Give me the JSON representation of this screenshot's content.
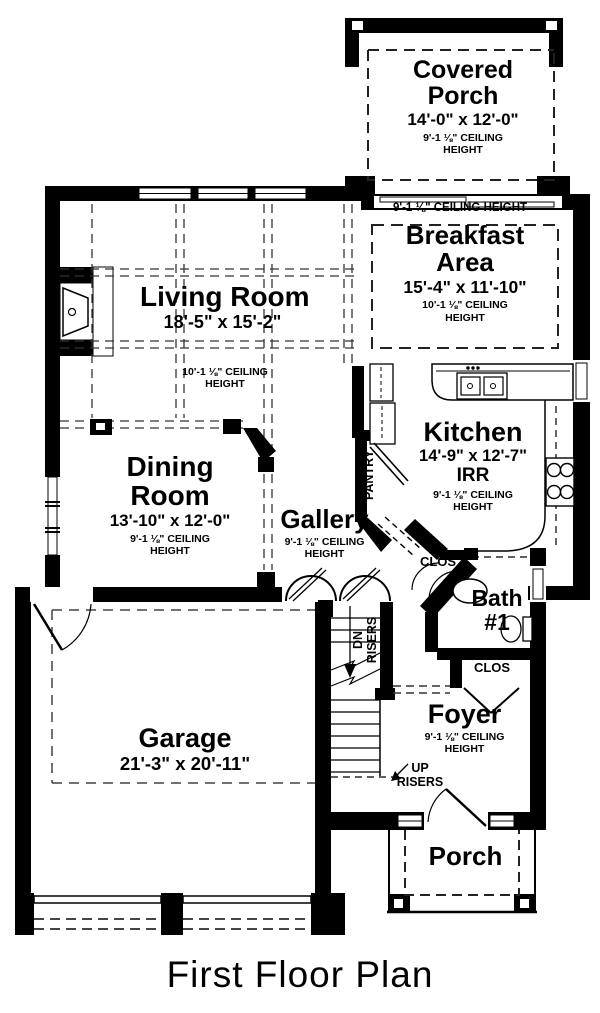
{
  "title": "First Floor Plan",
  "rooms": {
    "covered_porch": {
      "name": "Covered Porch",
      "dims": "14'-0\" x 12'-0\"",
      "ceiling": "9'-1 ⅛\" CEILING HEIGHT"
    },
    "entry_strip": {
      "ceiling": "9'-1 ⅛\" CEILING HEIGHT"
    },
    "breakfast": {
      "name": "Breakfast Area",
      "dims": "15'-4\" x 11'-10\"",
      "ceiling": "10'-1 ⅛\" CEILING HEIGHT"
    },
    "living": {
      "name": "Living Room",
      "dims": "18'-5\" x 15'-2\"",
      "ceiling": "10'-1 ⅛\" CEILING HEIGHT"
    },
    "kitchen": {
      "name": "Kitchen",
      "dims": "14'-9\" x 12'-7\"",
      "note": "IRR",
      "ceiling": "9'-1 ⅛\" CEILING HEIGHT"
    },
    "dining": {
      "name": "Dining Room",
      "dims": "13'-10\" x 12'-0\"",
      "ceiling": "9'-1 ⅛\" CEILING HEIGHT"
    },
    "gallery": {
      "name": "Gallery",
      "ceiling": "9'-1 ⅛\" CEILING HEIGHT"
    },
    "pantry": {
      "name": "PANTRY"
    },
    "closet_hall": {
      "name": "CLOS"
    },
    "bath": {
      "name": "Bath #1"
    },
    "closet_foyer": {
      "name": "CLOS"
    },
    "foyer": {
      "name": "Foyer",
      "ceiling": "9'-1 ⅛\" CEILING HEIGHT"
    },
    "garage": {
      "name": "Garage",
      "dims": "21'-3\" x 20'-11\""
    },
    "porch": {
      "name": "Porch"
    },
    "stairs": {
      "down": "DN RISERS",
      "up": "UP RISERS"
    }
  }
}
